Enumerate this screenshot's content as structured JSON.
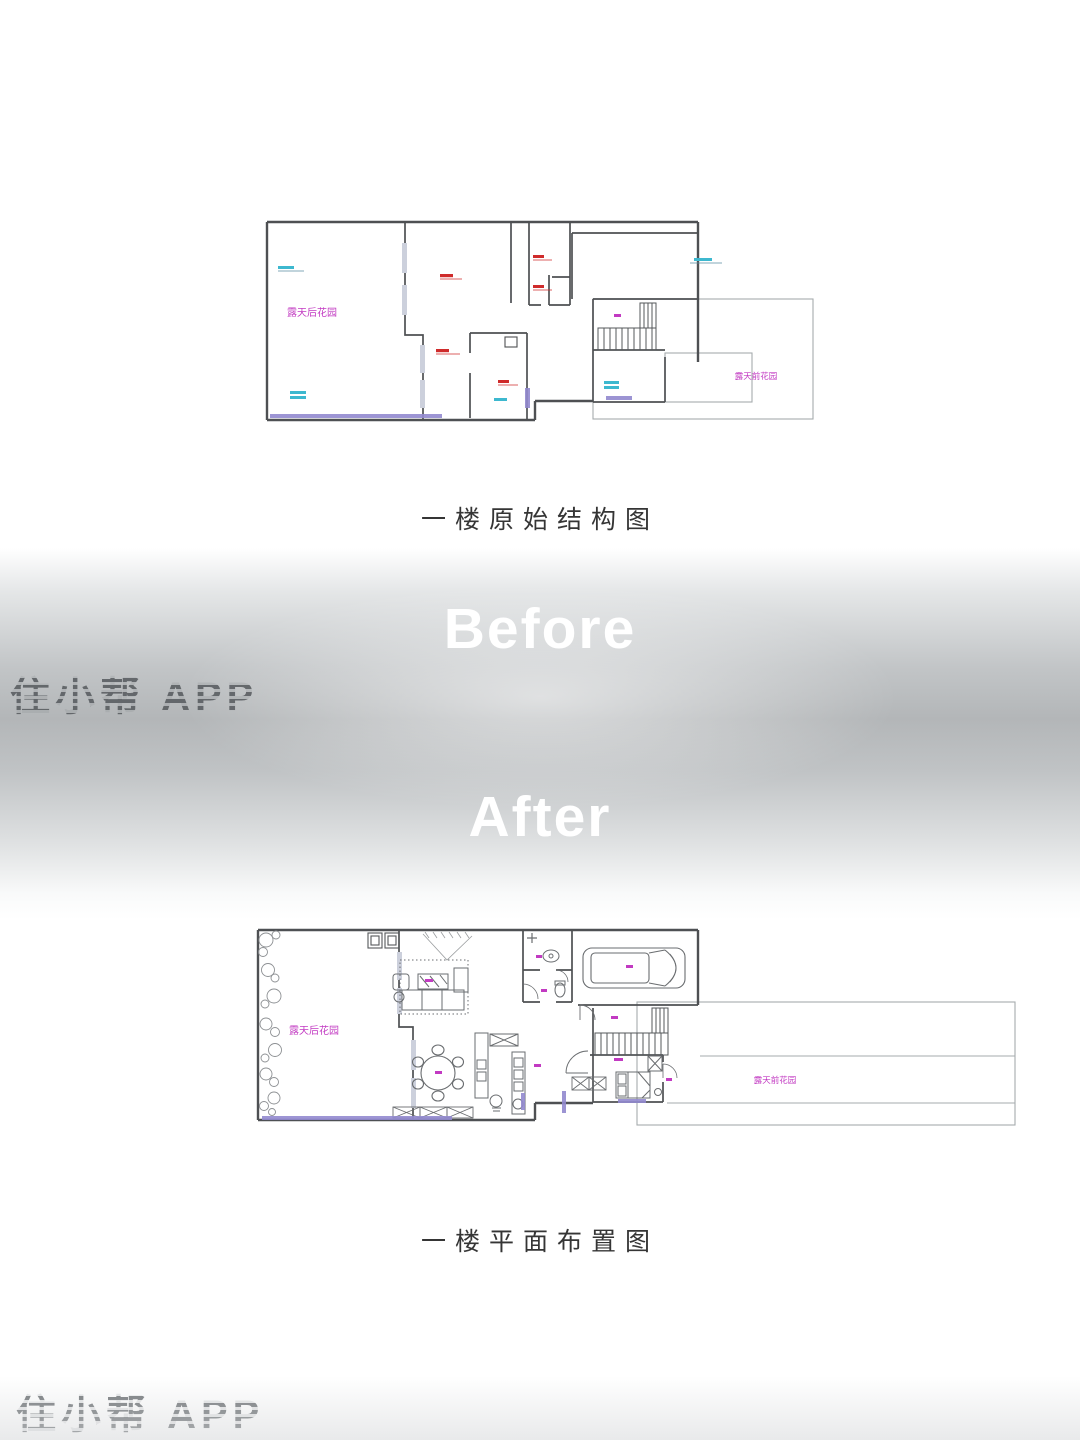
{
  "poster": {
    "captions": {
      "original": "一楼原始结构图",
      "layout": "一楼平面布置图"
    },
    "band": {
      "before": "Before",
      "after": "After"
    },
    "watermark": "住小帮 APP",
    "plan_original": {
      "back_garden_label": "露天后花园",
      "front_garden_label": "露天前花园"
    },
    "plan_layout": {
      "back_garden_label": "露天后花园",
      "front_garden_label": "露天前花园"
    },
    "colors": {
      "wall": "#4e5053",
      "thin_outline": "#a6abae",
      "label_magenta": "#c23ac2",
      "annotation_red": "#cf2b2b",
      "annotation_cyan": "#3db8cf",
      "sill_purple": "#9289cf",
      "band_gray": "#b3b6b8"
    }
  }
}
